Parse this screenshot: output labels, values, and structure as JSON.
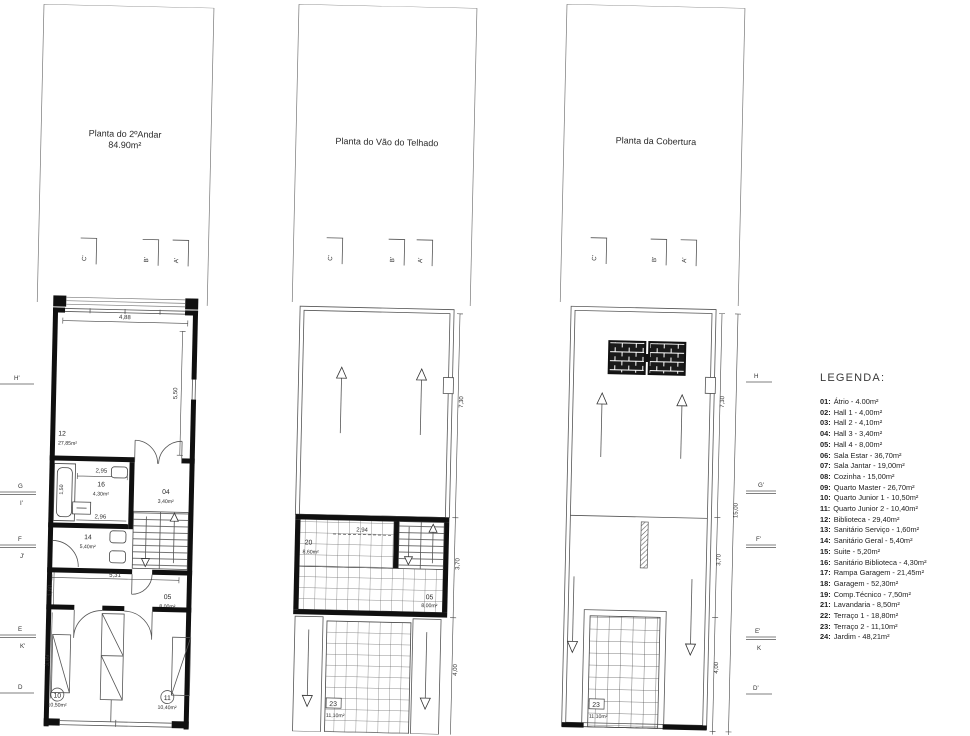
{
  "legend": {
    "title": "LEGENDA:",
    "items": [
      {
        "num": "01:",
        "text": "Átrio - 4.00m²"
      },
      {
        "num": "02:",
        "text": "Hall 1 - 4,00m²"
      },
      {
        "num": "03:",
        "text": "Hall 2 - 4,10m²"
      },
      {
        "num": "04:",
        "text": "Hall 3 - 3,40m²"
      },
      {
        "num": "05:",
        "text": "Hall 4 - 8,00m²"
      },
      {
        "num": "06:",
        "text": "Sala Estar - 36,70m²"
      },
      {
        "num": "07:",
        "text": "Sala Jantar - 19,00m²"
      },
      {
        "num": "08:",
        "text": "Cozinha - 15,00m²"
      },
      {
        "num": "09:",
        "text": "Quarto Master - 26,70m²"
      },
      {
        "num": "10:",
        "text": "Quarto Junior 1 - 10,50m²"
      },
      {
        "num": "11:",
        "text": "Quarto Junior 2 - 10,40m²"
      },
      {
        "num": "12:",
        "text": "Biblioteca - 29,40m²"
      },
      {
        "num": "13:",
        "text": "Sanitário Serviço - 1,60m²"
      },
      {
        "num": "14:",
        "text": "Sanitário Geral - 5,40m²"
      },
      {
        "num": "15:",
        "text": "Suite - 5,20m²"
      },
      {
        "num": "16:",
        "text": "Sanitário Biblioteca - 4,30m²"
      },
      {
        "num": "17:",
        "text": "Rampa Garagem - 21,45m²"
      },
      {
        "num": "18:",
        "text": "Garagem - 52,30m²"
      },
      {
        "num": "19:",
        "text": "Comp.Técnico - 7,50m²"
      },
      {
        "num": "21:",
        "text": "Lavandaria - 8,50m²"
      },
      {
        "num": "22:",
        "text": "Terraço 1 - 18,80m²"
      },
      {
        "num": "23:",
        "text": "Terraço 2 - 11,10m²"
      },
      {
        "num": "24:",
        "text": "Jardim - 48,21m²"
      }
    ]
  },
  "plan1": {
    "title": "Planta do 2ºAndar",
    "area": "84.90m²",
    "marker_c": "C'",
    "marker_b": "B'",
    "marker_a": "A'",
    "dims": {
      "d488": "4,88",
      "d550": "5,50",
      "d295": "2,95",
      "d150": "1,50",
      "d296": "2,96",
      "d531": "5,31",
      "d160": "1,60",
      "d389": "3,89"
    },
    "rooms": {
      "r12": {
        "num": "12",
        "area": "27,85m²"
      },
      "r16": {
        "num": "16",
        "area": "4,30m²"
      },
      "r04": {
        "num": "04",
        "area": "3,40m²"
      },
      "r14": {
        "num": "14",
        "area": "5,40m²"
      },
      "r05": {
        "num": "05",
        "area": "8,00m²"
      },
      "r10": {
        "num": "10",
        "area": "10,50m²"
      },
      "r11": {
        "num": "11",
        "area": "10,40m²"
      }
    }
  },
  "plan2": {
    "title": "Planta do Vão do Telhado",
    "marker_c": "C'",
    "marker_b": "B'",
    "marker_a": "A'",
    "dims": {
      "d730": "7,30",
      "d294": "2,94",
      "d370": "3,70",
      "d400": "4,00"
    },
    "rooms": {
      "r20": {
        "num": "20",
        "area": "8,60m²"
      },
      "r05": {
        "num": "05",
        "area": "8,00m²"
      },
      "r23": {
        "num": "23",
        "area": "11,10m²"
      }
    }
  },
  "plan3": {
    "title": "Planta da Cobertura",
    "marker_c": "C'",
    "marker_b": "B'",
    "marker_a": "A'",
    "dims": {
      "d730": "7,30",
      "d1500": "15,00",
      "d370": "3,70",
      "d400": "4,00"
    },
    "rooms": {
      "r23": {
        "num": "23",
        "area": "11,10m²"
      }
    }
  },
  "side_markers": {
    "left": {
      "l1": "H'",
      "l2": "G",
      "l2b": "I'",
      "l3": "F",
      "l3b": "J'",
      "l4": "E",
      "l4b": "K'",
      "l5": "D"
    },
    "right": {
      "r1": "H",
      "r2": "G'",
      "r3": "F'",
      "r4": "E'",
      "r4b": "K",
      "r5": "D'"
    }
  }
}
